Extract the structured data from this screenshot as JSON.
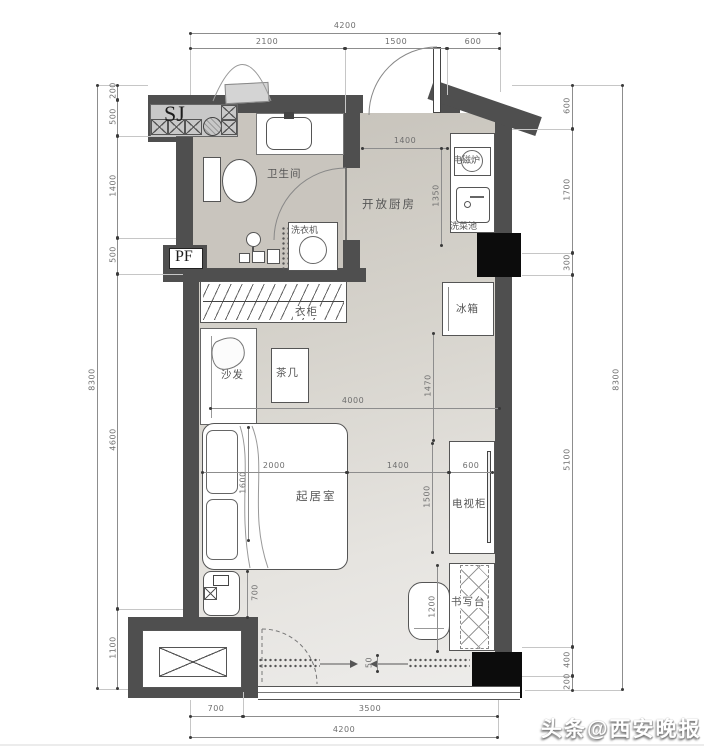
{
  "palette": {
    "wall": "#4f4f4f",
    "column": "#0c0c0c",
    "floor_dark": "#c6c2ba",
    "floor_light": "#edecea",
    "bath_floor": "#c9c5be"
  },
  "codes": {
    "sj": "SJ",
    "pf": "PF"
  },
  "rooms": {
    "bathroom": "卫生间",
    "kitchen": "开放厨房",
    "living": "起居室"
  },
  "furniture": {
    "washer": "洗衣机",
    "cooktop": "电磁炉",
    "sink": "洗菜池",
    "fridge": "冰箱",
    "wardrobe": "衣柜",
    "sofa": "沙发",
    "tea_table": "茶几",
    "tv_cabinet": "电视柜",
    "desk": "书写台"
  },
  "watermark": "头条@西安晚报",
  "dims": {
    "top_overall": "4200",
    "top_a": "2100",
    "top_b": "1500",
    "top_c": "600",
    "left_overall": "8300",
    "left_a": "200",
    "left_b": "500",
    "left_c": "1400",
    "left_d": "500",
    "left_e": "4600",
    "left_f": "1100",
    "right_overall": "8300",
    "right_a": "600",
    "right_b": "1700",
    "right_c": "300",
    "right_d": "5100",
    "right_e": "400",
    "right_f": "200",
    "bottom_a": "700",
    "bottom_b": "3500",
    "bottom_overall": "4200",
    "kitchen_w": "1400",
    "kitchen_d": "1350",
    "living_w": "4000",
    "right_mid": "1470",
    "bed_w": "2000",
    "mid_b": "1400",
    "tv_w": "600",
    "bed_l": "1600",
    "tv_l": "1500",
    "bed_gap": "700",
    "desk_l": "1200",
    "track": "50"
  }
}
